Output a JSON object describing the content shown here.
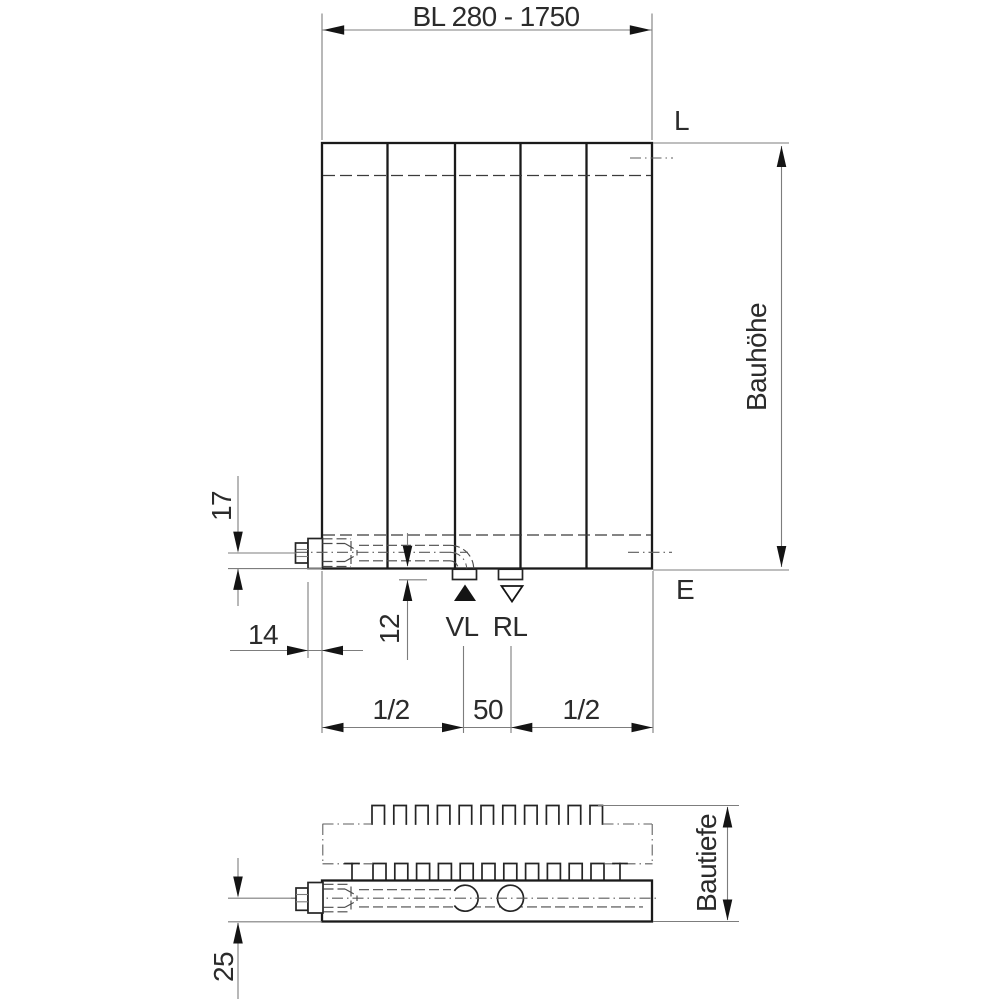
{
  "colors": {
    "background": "#ffffff",
    "outline": "#1a1a1a",
    "dimension_line": "#7d7d7d",
    "text": "#2b2b2b"
  },
  "labels": {
    "length_dimension": "BL 280 - 1750",
    "height_dimension": "Bauhöhe",
    "depth_dimension": "Bautiefe",
    "vent_connection": "L",
    "drain_connection": "E",
    "supply": "VL",
    "return": "RL"
  },
  "dimensions": {
    "connection_center_to_bottom": "17",
    "connector_width": "14",
    "stub_protrusion": "12",
    "left_spacing": "1/2",
    "center_distance": "50",
    "right_spacing": "1/2",
    "section_center_to_front": "25"
  }
}
